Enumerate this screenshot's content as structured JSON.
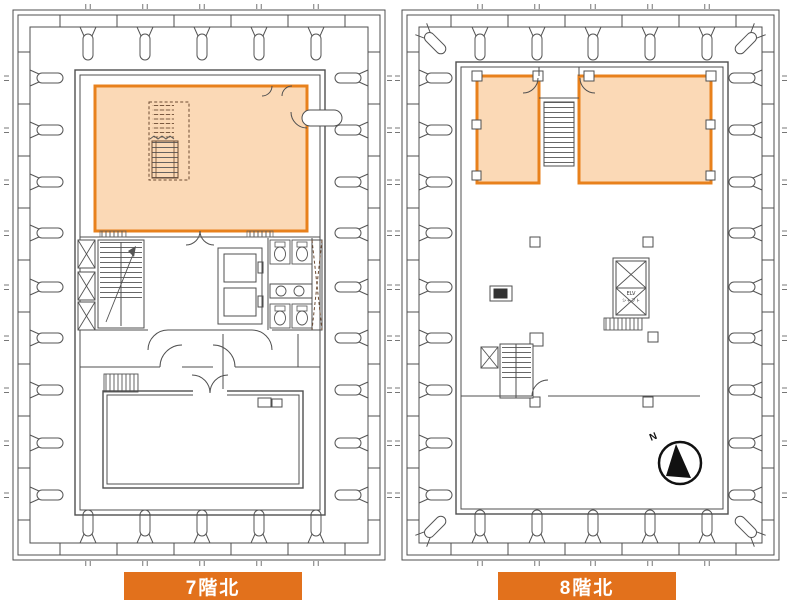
{
  "figure": {
    "description_type": "floor-plan-comparison"
  },
  "floor_plans": {
    "left": {
      "label": "7階北"
    },
    "right": {
      "label": "8階北",
      "north_arrow_label": "N",
      "elv_shaft_label": [
        "ELV",
        "シャフト"
      ]
    }
  },
  "colors": {
    "highlight_fill": "#fbd9b6",
    "highlight_border": "#e8811c",
    "banner_bg": "#e2711c",
    "banner_text": "#ffffff",
    "line": "#4f4f4f",
    "background": "#ffffff"
  }
}
